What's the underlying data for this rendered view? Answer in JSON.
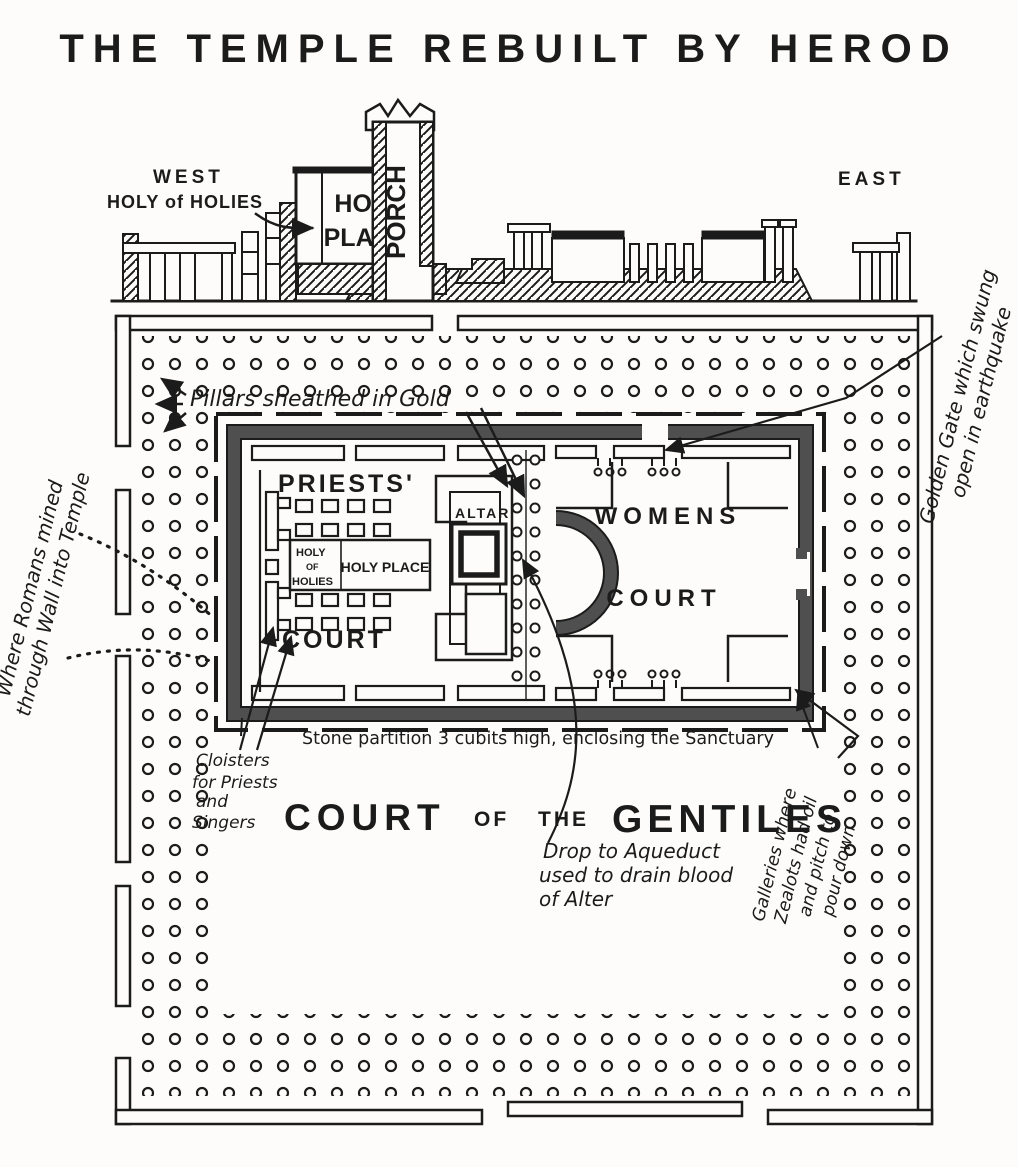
{
  "title": "THE TEMPLE REBUILT BY HEROD",
  "elevation": {
    "west_label": "WEST",
    "east_label": "EAST",
    "holy_of_holies_label": "HOLY of HOLIES",
    "holy_place_line1": "HOLY",
    "holy_place_line2": "PLACE",
    "porch_label": "PORCH"
  },
  "plan": {
    "priests_court_line1": "PRIESTS'",
    "priests_court_line2": "COURT",
    "holy_of_holies_line1": "HOLY",
    "holy_of_holies_line2": "OF",
    "holy_of_holies_line3": "HOLIES",
    "holy_place": "HOLY PLACE",
    "altar": "ALTAR",
    "womens_court_line1": "WOMENS",
    "womens_court_line2": "COURT",
    "gentiles_word1": "COURT",
    "gentiles_word2": "OF",
    "gentiles_word3": "THE",
    "gentiles_word4": "GENTILES"
  },
  "annotations": {
    "pillars_gold": "Pillars sheathed in Gold",
    "golden_gate": [
      "Golden Gate which swung",
      "open in earthquake"
    ],
    "romans": [
      "Where Romans mined",
      "through Wall into Temple"
    ],
    "cloisters": [
      "Cloisters",
      "for Priests",
      "and",
      "Singers"
    ],
    "stone_partition": "Stone partition 3 cubits high, enclosing the Sanctuary",
    "aqueduct": [
      "Drop to Aqueduct",
      "used to drain blood",
      "of Alter"
    ],
    "galleries": [
      "Galleries where",
      "Zealots had oil",
      "and pitch to",
      "pour down"
    ]
  },
  "colors": {
    "ink": "#1b1b1b",
    "wall_shade": "#4f4f4f",
    "paper": "#fdfcfa"
  }
}
